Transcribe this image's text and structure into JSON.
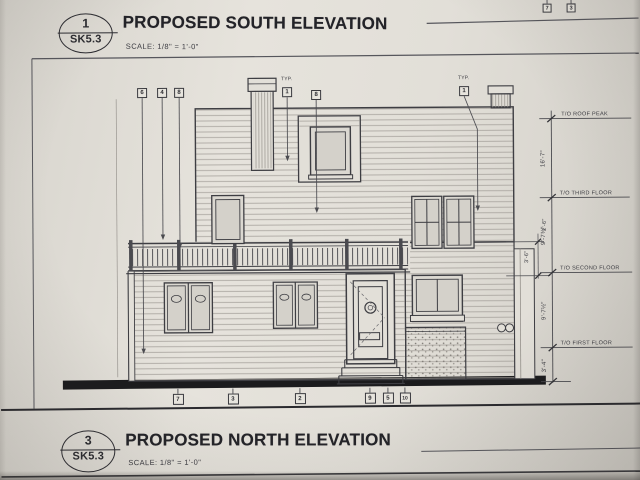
{
  "drawings": {
    "south": {
      "bubble_number": "1",
      "bubble_sheet": "SK5.3",
      "title": "PROPOSED SOUTH ELEVATION",
      "scale": "SCALE:  1/8\" = 1'-0\""
    },
    "north": {
      "bubble_number": "3",
      "bubble_sheet": "SK5.3",
      "title": "PROPOSED NORTH ELEVATION",
      "scale": "SCALE:  1/8\" = 1'-0\""
    }
  },
  "levels": {
    "roof_peak": {
      "label": "T/O ROOF PEAK",
      "dim_below": "16'-7\""
    },
    "third": {
      "label": "T/O THIRD FLOOR",
      "dim_below": "9'-7¾\""
    },
    "second": {
      "label": "T/O SECOND FLOOR",
      "dim_below": "9'-7½\""
    },
    "first": {
      "label": "T/O FIRST FLOOR",
      "dim_below": "3'-4\""
    }
  },
  "railing_dims": {
    "upper": "2'-6\"",
    "lower": "3'-6\""
  },
  "callouts": {
    "typ_note": "TYP.",
    "top_edge": [
      "7",
      "3"
    ],
    "upper_row": [
      "6",
      "4",
      "8",
      "1",
      "8",
      "1"
    ],
    "bottom_row": [
      "7",
      "3",
      "2",
      "9",
      "5",
      "10"
    ]
  },
  "colors": {
    "paper": "#e2dfd8",
    "ink": "#2b2b30",
    "ground": "#1b1b1d"
  }
}
